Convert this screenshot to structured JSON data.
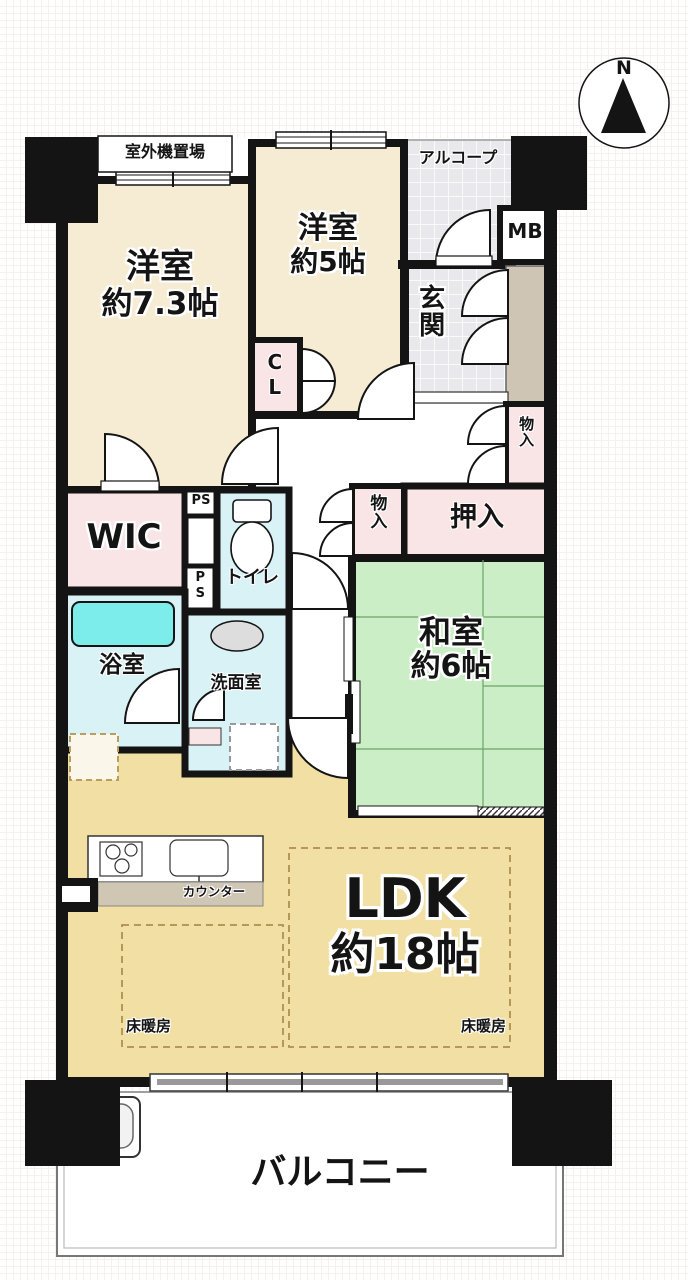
{
  "compass": {
    "label": "N"
  },
  "labels": {
    "outdoor_unit": "室外機置場",
    "alcove": "アルコープ",
    "meter_box": "MB",
    "entrance": "玄関",
    "western1_name": "洋室",
    "western1_size": "約7.3帖",
    "western2_name": "洋室",
    "western2_size": "約5帖",
    "closet": "CL",
    "storage_upper": "物入",
    "storage_lower": "物入",
    "oshiire": "押入",
    "japanese_name": "和室",
    "japanese_size": "約6帖",
    "wic": "WIC",
    "ps_upper": "PS",
    "ps_lower": "PS",
    "toilet": "トイレ",
    "bath": "浴室",
    "washroom": "洗面室",
    "counter": "カウンター",
    "ldk_name": "LDK",
    "ldk_size": "約18帖",
    "floor_heating_left": "床暖房",
    "floor_heating_right": "床暖房",
    "balcony": "バルコニー"
  },
  "colors": {
    "wall": "#141414",
    "western_room": "#f6ecd4",
    "ldk": "#f2dfa4",
    "japanese_room": "#cbeec6",
    "storage_pink": "#f9e5e5",
    "wet_area_blue": "#d9f2f6",
    "bathtub": "#7dedec",
    "tile": "#e9e9ed",
    "shoe_cabinet": "#cfc5b5",
    "counter_top": "#cfc6b3"
  }
}
